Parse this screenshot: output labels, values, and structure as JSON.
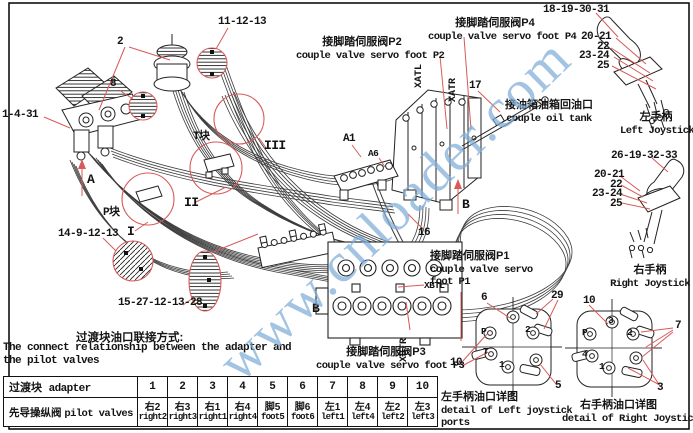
{
  "watermark": {
    "text": "www.cnloader.com"
  },
  "colors": {
    "red": "#d85a5a",
    "ink": "#141414",
    "watermark_blue": "#7fadd8"
  },
  "labels": {
    "n11_12_13": "11-12-13",
    "n2": "2",
    "n8": "8",
    "n1_4_31": "1-4-31",
    "t_block": "T块",
    "p_block": "P块",
    "r1": "I",
    "r2": "II",
    "r3": "III",
    "arrow_a": "A",
    "arrow_b": "B",
    "block_b": "B",
    "n14": "14-9-12-13",
    "n15": "15-27-12-13-28",
    "a1": "A1",
    "a6": "A6",
    "n16": "16",
    "n17": "17",
    "xatl": "XATL",
    "xatr": "XATR",
    "xbtl": "XBTL",
    "xbtr": "XBTR",
    "n18": "18-19-30-31",
    "n26": "26-19-32-33",
    "jg1": "20-21",
    "jg2": "22",
    "jg3": "23-24",
    "jg4": "25"
  },
  "captions": {
    "p2_zh": "接脚踏伺服阀P2",
    "p2_en": "couple valve servo foot P2",
    "p4_zh": "接脚踏伺服阀P4",
    "p4_en": "couple valve servo foot P4",
    "p1_zh": "接脚踏伺服阀P1",
    "p1_en1": "couple valve servo",
    "p1_en2": "foot P1",
    "p3_zh": "接脚踏伺服阀P3",
    "p3_en": "couple valve servo foot P3",
    "tank_zh": "接油箱油箱回油口",
    "tank_en": "couple oil tank",
    "ljoy_zh": "左手柄",
    "ljoy_en": "Left Joystick",
    "rjoy_zh": "右手柄",
    "rjoy_en": "Right Joystick",
    "ldetail_zh": "左手柄油口详图",
    "ldetail_en1": "detail of Left joystick",
    "ldetail_en2": "ports",
    "rdetail_zh": "右手柄油口详图",
    "rdetail_en": "detail of Right Joystick po",
    "note_zh": "过渡块油口联接方式:",
    "note_en1": "The connect relationship between the adapter and",
    "note_en2": "the pilot valves"
  },
  "ldetail": {
    "n6": "6",
    "n29": "29",
    "n10": "10",
    "n5": "5",
    "pP": "P",
    "p2": "2",
    "pT": "T",
    "p1": "1"
  },
  "rdetail": {
    "n10": "10",
    "n7": "7",
    "n3": "3",
    "pP": "P",
    "p3": "3",
    "p2": "2",
    "p4": "4",
    "p1": "1"
  },
  "table": {
    "row1_zh": "过渡块",
    "row1_en": "adapter",
    "row2_zh": "先导操纵阀",
    "row2_en": "pilot valves",
    "columns": [
      {
        "num": "1",
        "zh": "右2",
        "en": "right2"
      },
      {
        "num": "2",
        "zh": "右3",
        "en": "right3"
      },
      {
        "num": "3",
        "zh": "右1",
        "en": "right1"
      },
      {
        "num": "4",
        "zh": "右4",
        "en": "right4"
      },
      {
        "num": "5",
        "zh": "脚5",
        "en": "foot5"
      },
      {
        "num": "6",
        "zh": "脚6",
        "en": "foot6"
      },
      {
        "num": "7",
        "zh": "左1",
        "en": "left1"
      },
      {
        "num": "8",
        "zh": "左4",
        "en": "left4"
      },
      {
        "num": "9",
        "zh": "左2",
        "en": "left2"
      },
      {
        "num": "10",
        "zh": "左3",
        "en": "left3"
      }
    ]
  }
}
